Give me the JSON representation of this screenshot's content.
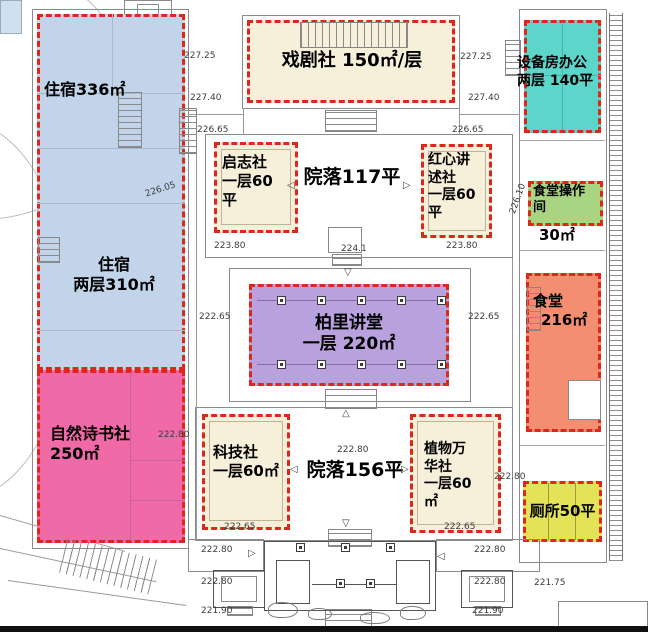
{
  "zones": {
    "dorm_top": {
      "label": "住宿336㎡",
      "color": "#c1d4e9"
    },
    "dorm_bottom": {
      "line1": "住宿",
      "line2": "两层310㎡",
      "color": "#c1d4e9"
    },
    "drama": {
      "label": "戏剧社 150㎡/层",
      "color": "#f6efda"
    },
    "equipment": {
      "line1": "设备房办公",
      "line2": "两层 140平",
      "color": "#5cd5ca"
    },
    "qizhi": {
      "line1": "启志社",
      "line2": "一层60",
      "line3": "平",
      "color": "#f6efda"
    },
    "redheart": {
      "line1": "红心讲",
      "line2": "述社",
      "line3": "一层60",
      "line4": "平",
      "color": "#f6efda"
    },
    "canteen_op": {
      "line1": "食堂操作",
      "line2": "间",
      "area": "30㎡",
      "color": "#a9d481"
    },
    "lecture": {
      "line1": "柏里讲堂",
      "line2": "一层 220㎡",
      "color": "#b9a1de"
    },
    "canteen": {
      "line1": "食堂",
      "line2": "216㎡",
      "color": "#f48e70"
    },
    "nature": {
      "line1": "自然诗书社",
      "line2": "250㎡",
      "color": "#f06aa7"
    },
    "tech": {
      "line1": "科技社",
      "line2": "一层60㎡",
      "color": "#f6efda"
    },
    "plant": {
      "line1": "植物万",
      "line2": "华社",
      "line3": "一层60",
      "line4": "㎡",
      "color": "#f6efda"
    },
    "toilet": {
      "label": "厕所50平",
      "color": "#e4e257"
    }
  },
  "courtyards": {
    "upper": "院落117平",
    "lower": "院落156平"
  },
  "elevations": [
    "227.25",
    "227.40",
    "226.65",
    "227.25",
    "227.40",
    "226.65",
    "223.80",
    "224.1",
    "223.80",
    "222.65",
    "222.65",
    "222.80",
    "222.80",
    "222.65",
    "222.65",
    "222.80",
    "222.80",
    "222.80",
    "221.90",
    "222.80",
    "222.80",
    "221.90",
    "221.75",
    "226.05",
    "226.10"
  ],
  "icons": {
    "arrow_left": "◁",
    "arrow_right": "▷",
    "arrow_up": "△",
    "arrow_down": "▽"
  },
  "style": {
    "dash_color": "#e0261a",
    "line_color": "#8a8a8a"
  }
}
